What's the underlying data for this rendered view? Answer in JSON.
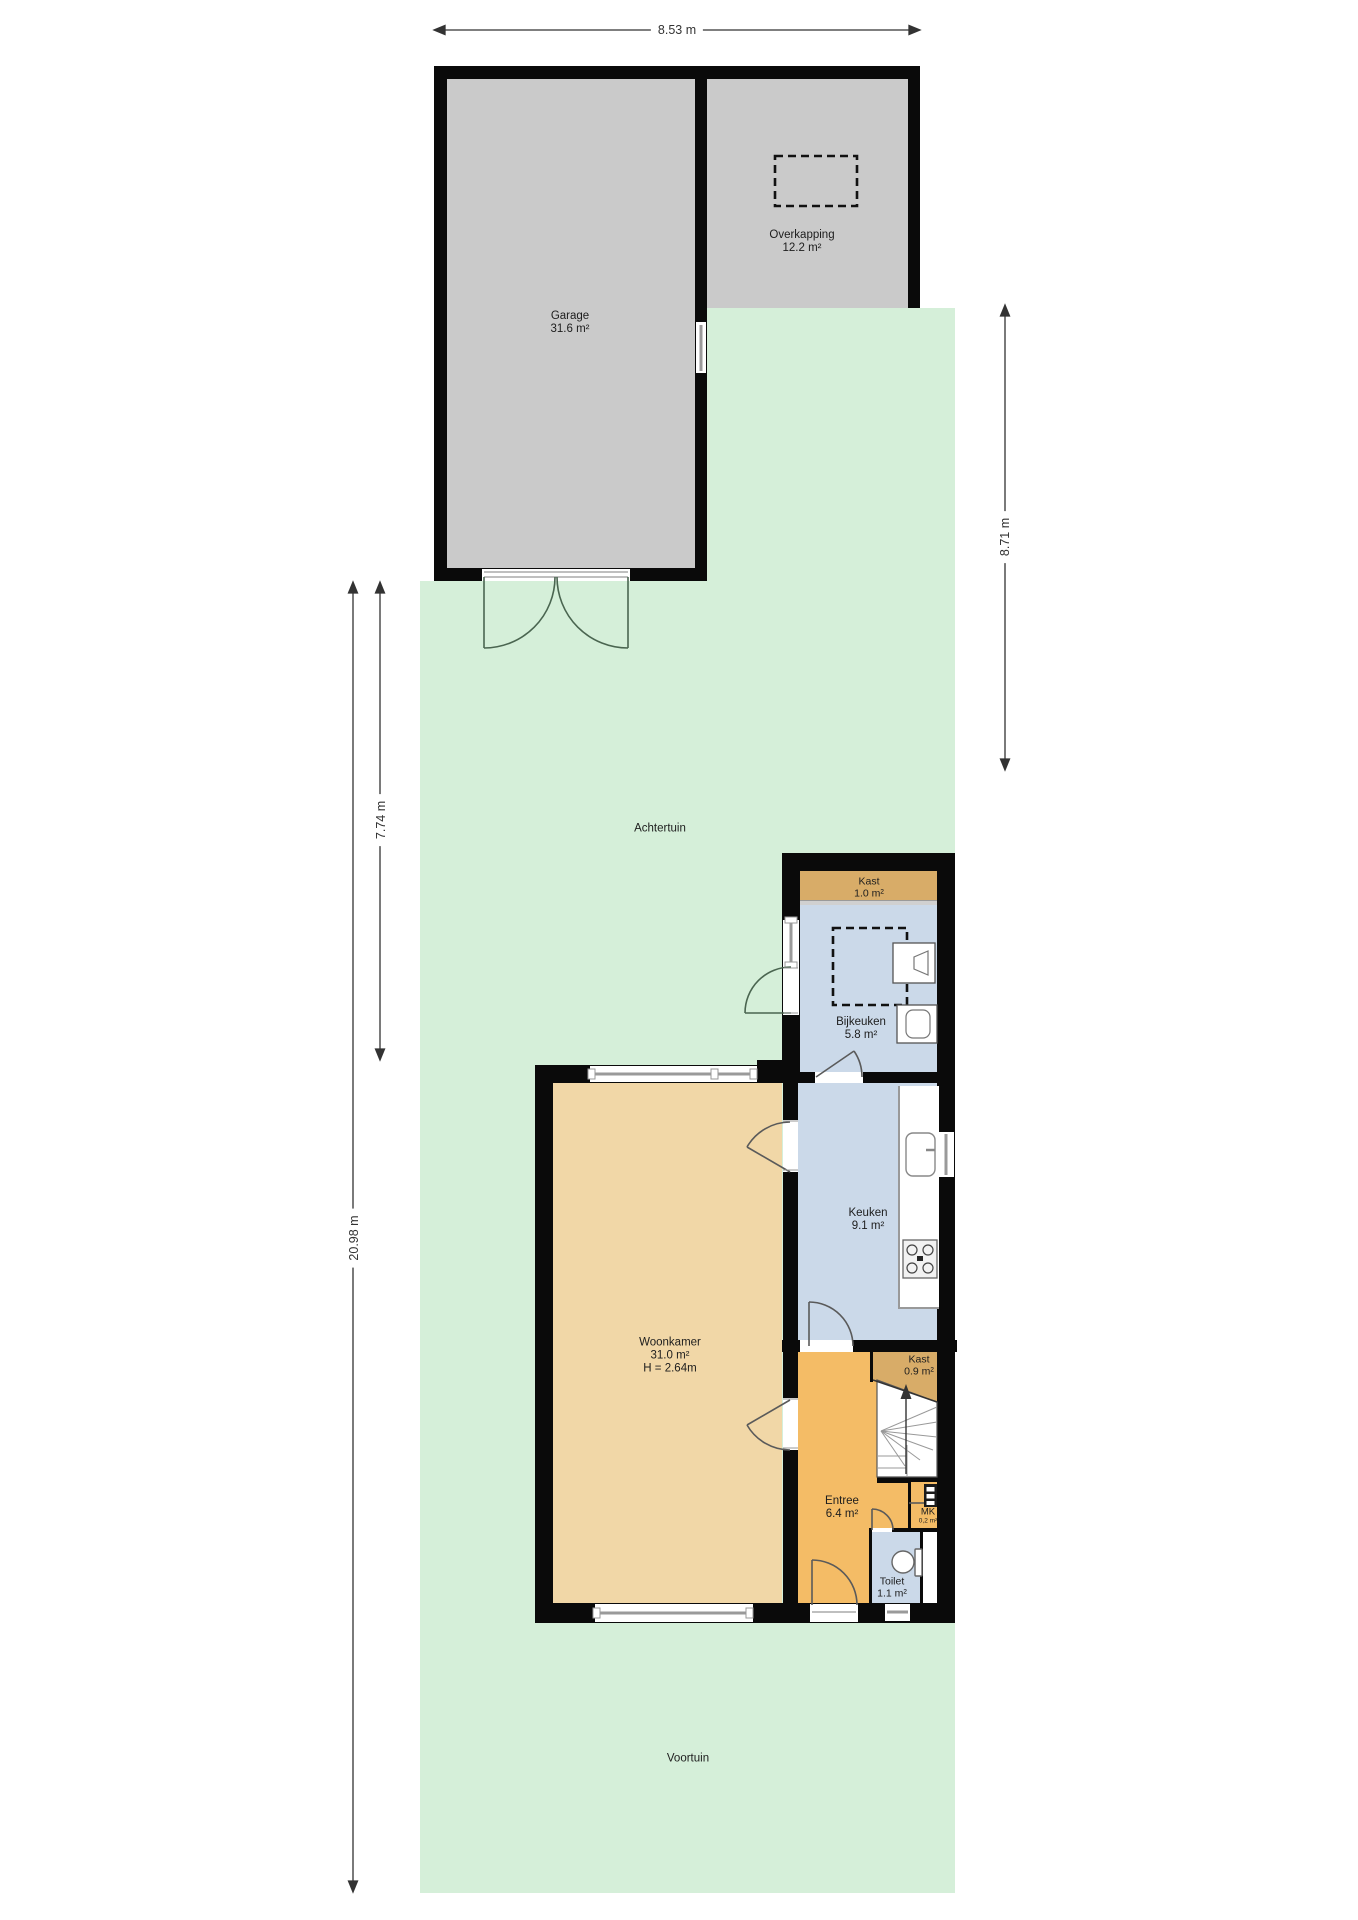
{
  "plan": {
    "dimensions": {
      "top": "8.53 m",
      "right": "8.71 m",
      "left_inner": "7.74 m",
      "left_outer": "20.98 m"
    },
    "gardens": {
      "back": "Achtertuin",
      "front": "Voortuin"
    },
    "rooms": {
      "garage": {
        "name": "Garage",
        "area": "31.6 m²"
      },
      "overkapping": {
        "name": "Overkapping",
        "area": "12.2 m²"
      },
      "kast_boven": {
        "name": "Kast",
        "area": "1.0 m²"
      },
      "bijkeuken": {
        "name": "Bijkeuken",
        "area": "5.8 m²"
      },
      "keuken": {
        "name": "Keuken",
        "area": "9.1 m²"
      },
      "woonkamer": {
        "name": "Woonkamer",
        "area": "31.0 m²",
        "height": "H = 2.64m"
      },
      "kast_trap": {
        "name": "Kast",
        "area": "0.9 m²"
      },
      "entree": {
        "name": "Entree",
        "area": "6.4 m²"
      },
      "meterkast": {
        "name": "MK",
        "area": "0,2 m²"
      },
      "toilet": {
        "name": "Toilet",
        "area": "1.1 m²"
      }
    },
    "colors": {
      "garden": "#d5efd9",
      "floor_gray": "#cacaca",
      "wall": "#0a0a0a",
      "living": "#f1d7a7",
      "hall": "#f4bc66",
      "closet": "#d8ac68",
      "wet_rooms": "#cbd9e9"
    }
  }
}
